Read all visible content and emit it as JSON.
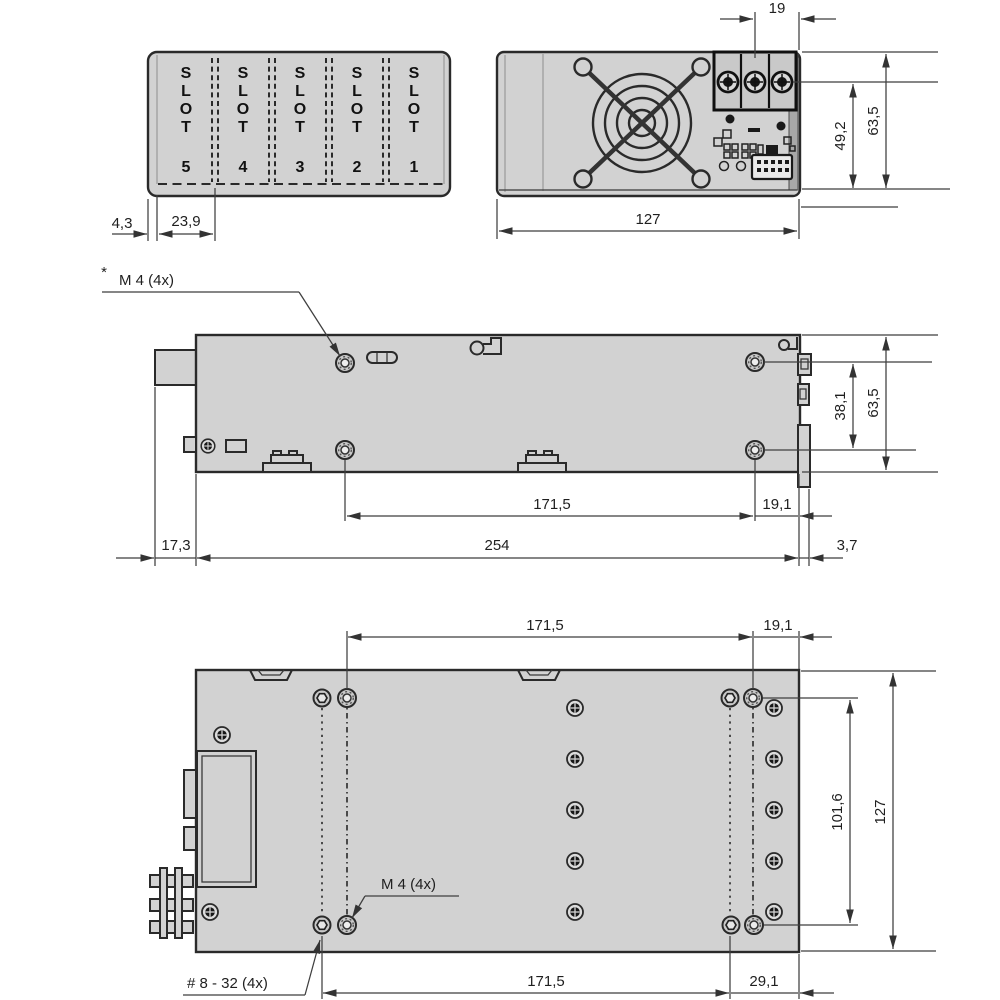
{
  "meta": {
    "description": "Mechanical dimension drawing of a slot-type power supply enclosure with four views: slot top view, front (fan) view, side view and bottom mounting view",
    "units_decimal_separator": "comma"
  },
  "colors": {
    "background": "#ffffff",
    "body_fill": "#d2d2d2",
    "outline": "#2a2a2a",
    "dimension_line": "#3f3f3f",
    "text": "#1f1f1f"
  },
  "slot_view": {
    "letters": [
      "S",
      "L",
      "O",
      "T"
    ],
    "numbers": [
      "5",
      "4",
      "3",
      "2",
      "1"
    ],
    "dims": {
      "edge": "4,3",
      "pitch": "23,9"
    }
  },
  "front_view": {
    "dims": {
      "terminal_pitch": "19",
      "screw_height": "49,2",
      "height": "63,5",
      "width": "127"
    }
  },
  "side_view": {
    "notes": {
      "star": "*",
      "m4": "M 4 (4x)"
    },
    "dims": {
      "hole_spacing_v": "38,1",
      "height": "63,5",
      "hole_span": "171,5",
      "hole_to_rear": "19,1",
      "front_offset": "17,3",
      "length": "254",
      "rear_offset": "3,7"
    }
  },
  "bottom_view": {
    "notes": {
      "m4": "M 4 (4x)",
      "screw": "# 8 - 32 (4x)"
    },
    "dims": {
      "hole_span_top": "171,5",
      "hole_to_edge_top": "19,1",
      "hole_spacing_v": "101,6",
      "width": "127",
      "hole_span_bottom": "171,5",
      "hole_to_edge_bottom": "29,1"
    }
  }
}
